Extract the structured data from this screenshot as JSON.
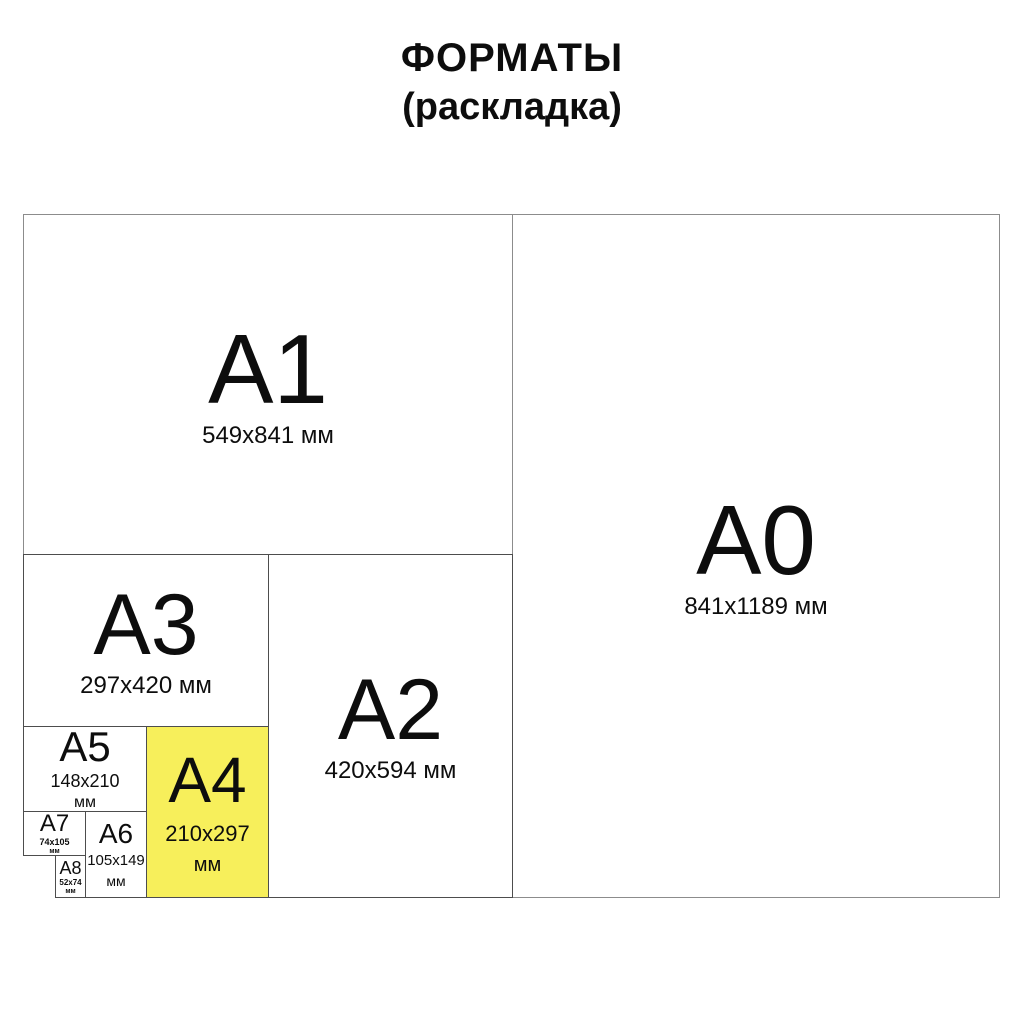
{
  "title": {
    "line1": "ФОРМАТЫ",
    "line2": "(раскладка)"
  },
  "colors": {
    "background": "#ffffff",
    "text": "#0d0d0d",
    "line": "#4d4d4d",
    "line_outer": "#8c8c8c",
    "highlight": "#f7ef5b"
  },
  "formats": {
    "a0": {
      "label": "A0",
      "dims": "841x1189 мм"
    },
    "a1": {
      "label": "A1",
      "dims": "549x841 мм"
    },
    "a2": {
      "label": "A2",
      "dims": "420x594 мм"
    },
    "a3": {
      "label": "A3",
      "dims": "297x420 мм"
    },
    "a4": {
      "label": "A4",
      "dims": "210x297",
      "unit": "мм",
      "highlighted": true
    },
    "a5": {
      "label": "A5",
      "dims": "148x210",
      "unit": "мм"
    },
    "a6": {
      "label": "A6",
      "dims": "105x149",
      "unit": "мм"
    },
    "a7": {
      "label": "A7",
      "dims": "74x105",
      "unit": "мм"
    },
    "a8": {
      "label": "A8",
      "dims": "52x74",
      "unit": "мм"
    }
  }
}
